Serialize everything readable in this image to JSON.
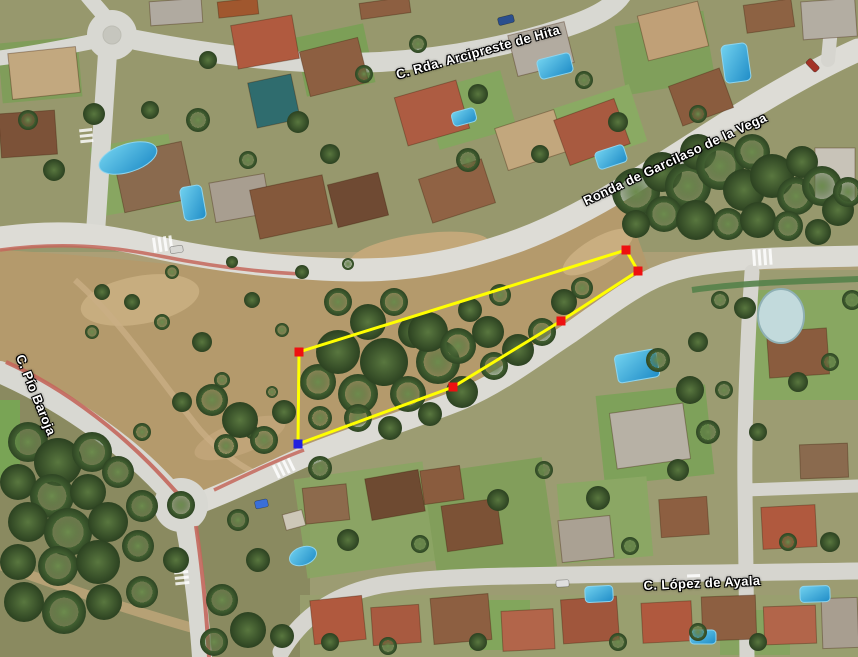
{
  "map": {
    "street_labels": [
      {
        "text": "C. Rda. Arcipreste de Hita",
        "x": 478,
        "y": 52,
        "rotation": -15.5
      },
      {
        "text": "Ronda de Garcilaso de la Vega",
        "x": 675,
        "y": 159,
        "rotation": -25
      },
      {
        "text": "C. Pío Baroja",
        "x": 36,
        "y": 395,
        "rotation": 68
      },
      {
        "text": "C. López de Ayala",
        "x": 702,
        "y": 583,
        "rotation": -2.5
      }
    ],
    "measurement_overlay": {
      "path_color": "#ffff00",
      "marker_colors": {
        "point": "#ee1010",
        "start": "#2121dd"
      },
      "marker_size": 9,
      "vertices": [
        {
          "x": 298,
          "y": 444,
          "marker": "start"
        },
        {
          "x": 299,
          "y": 352,
          "marker": "point"
        },
        {
          "x": 626,
          "y": 250,
          "marker": "point"
        },
        {
          "x": 638,
          "y": 271,
          "marker": "point"
        },
        {
          "x": 561,
          "y": 321,
          "marker": "point"
        },
        {
          "x": 453,
          "y": 387,
          "marker": "point"
        }
      ]
    }
  }
}
